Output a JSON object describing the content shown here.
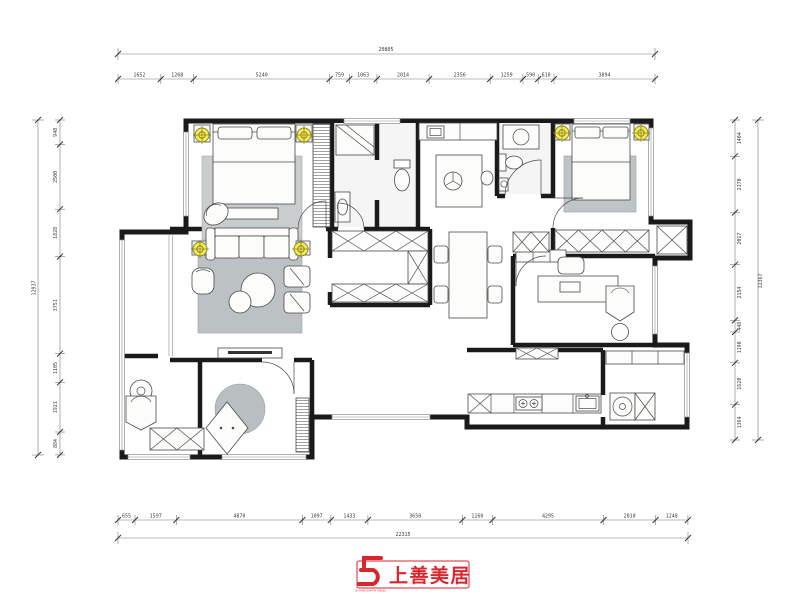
{
  "page": {
    "background": "#ffffff",
    "type": "residential interior floor plan drawing",
    "unit": "mm"
  },
  "dimensions": {
    "top": {
      "total": "20805",
      "segments": [
        "1652",
        "1268",
        "5240",
        "759",
        "1063",
        "2014",
        "2356",
        "1259",
        "590",
        "610",
        "3894"
      ]
    },
    "bottom": {
      "total": "22315",
      "segments": [
        "655",
        "1597",
        "4870",
        "1097",
        "1433",
        "3650",
        "1160",
        "4295",
        "2010",
        "1248"
      ]
    },
    "left": {
      "total": "12937",
      "segments": [
        "948",
        "2500",
        "1828",
        "3751",
        "1105",
        "1921",
        "884"
      ]
    },
    "right": {
      "total": "12367",
      "segments": [
        "1404",
        "2170",
        "2017",
        "2154",
        "448",
        "1190",
        "1620",
        "1364"
      ]
    }
  },
  "logo": {
    "name": "上善美居",
    "subtext": "SHANGSHAN MEIJU",
    "color": "#d8262c",
    "mark": "stylized-S-monogram"
  },
  "plan": {
    "colors": {
      "wall": "#1a1a1a",
      "floor": "#d9dcd9",
      "bath_floor": "#f4f5f4",
      "rug": "#bcc1c3",
      "rug_light": "#c9cdce",
      "light_symbol": "#f5ec4b"
    },
    "symbols": {
      "ceiling_light": "circled-crosshair-yellow",
      "wardrobe": "x-hatched-cabinet",
      "hanging_rail": "horizontal-stripes",
      "window": "double-line-glazing"
    },
    "areas": [
      "master-bedroom",
      "master-bathroom",
      "walk-in-closet",
      "living-room",
      "balcony",
      "kids-bedroom",
      "hallway-dining",
      "kitchen",
      "powder-room",
      "bedroom-2",
      "study",
      "utility-laundry"
    ]
  }
}
